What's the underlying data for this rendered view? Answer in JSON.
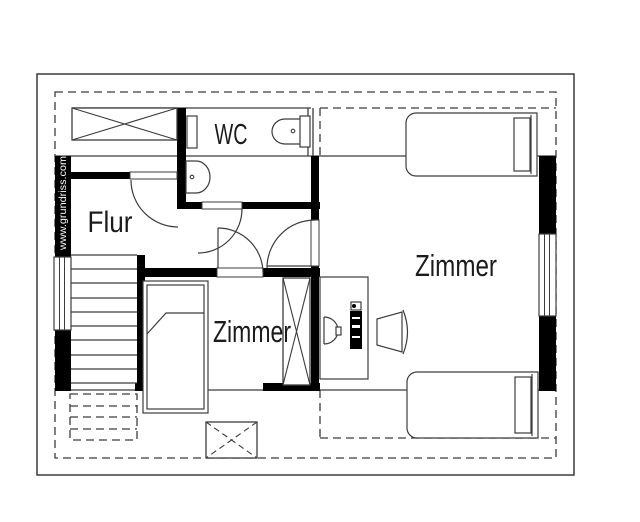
{
  "plan": {
    "meta": {
      "canvas_w": 640,
      "canvas_h": 522,
      "bg": "#ffffff",
      "line_color": "#3c3c3c",
      "wall_color": "#000000",
      "text_color": "#1c1c1c",
      "dash_pattern": "8,5",
      "cross_dash_pattern": "6,4"
    },
    "watermark": {
      "text": "www.grundriss.com",
      "color": "#ffffff",
      "x": 66,
      "y": 203,
      "font_size": 10.5,
      "text_length": 94,
      "rotation": -90
    },
    "room_labels": [
      {
        "name": "room-label-wc",
        "text": "WC",
        "x": 231,
        "y": 144,
        "font_size": 29,
        "text_length": 33
      },
      {
        "name": "room-label-flur",
        "text": "Flur",
        "x": 110,
        "y": 232,
        "font_size": 30,
        "text_length": 45
      },
      {
        "name": "room-label-zimmer-small",
        "text": "Zimmer",
        "x": 252,
        "y": 342,
        "font_size": 31,
        "text_length": 78
      },
      {
        "name": "room-label-zimmer-large",
        "text": "Zimmer",
        "x": 456,
        "y": 276,
        "font_size": 31,
        "text_length": 82
      }
    ],
    "roof_outline": {
      "name": "roof-outline",
      "x": 37,
      "y": 74,
      "w": 537,
      "h": 401
    },
    "dashed_rects": [
      {
        "name": "roof-edge-dashed",
        "x": 55,
        "y": 92,
        "w": 501,
        "h": 366
      },
      {
        "name": "stairs-under-roof-dashed",
        "x": 70,
        "y": 394,
        "w": 67,
        "h": 46
      }
    ],
    "dashed_lines": [
      {
        "name": "knee-dashed-top-h",
        "x1": 320,
        "y1": 108,
        "x2": 556,
        "y2": 108
      },
      {
        "name": "knee-dashed-top-v",
        "x1": 320,
        "y1": 108,
        "x2": 320,
        "y2": 156
      },
      {
        "name": "knee-dashed-bottom-h",
        "x1": 320,
        "y1": 438,
        "x2": 556,
        "y2": 438
      },
      {
        "name": "knee-dashed-bottom-v",
        "x1": 320,
        "y1": 390,
        "x2": 320,
        "y2": 438
      },
      {
        "name": "stairs-dashed-step-1",
        "x1": 70,
        "y1": 406,
        "x2": 137,
        "y2": 406
      },
      {
        "name": "stairs-dashed-step-2",
        "x1": 70,
        "y1": 417,
        "x2": 137,
        "y2": 417
      },
      {
        "name": "stairs-dashed-step-3",
        "x1": 70,
        "y1": 429,
        "x2": 137,
        "y2": 429
      }
    ],
    "lines": [
      {
        "name": "knee-line-top",
        "x1": 55,
        "y1": 156,
        "x2": 556,
        "y2": 156
      },
      {
        "name": "upper-row-top-line",
        "x1": 72,
        "y1": 108,
        "x2": 311,
        "y2": 108
      },
      {
        "name": "knee-line-bottom",
        "x1": 55,
        "y1": 390,
        "x2": 556,
        "y2": 390
      },
      {
        "name": "wc-upper-right-line-1",
        "x1": 308,
        "y1": 108,
        "x2": 308,
        "y2": 156
      },
      {
        "name": "wc-upper-right-line-2",
        "x1": 313,
        "y1": 108,
        "x2": 313,
        "y2": 156
      }
    ],
    "walls": [
      {
        "name": "wall-left-upper",
        "x": 55,
        "y": 156,
        "w": 16,
        "h": 101
      },
      {
        "name": "wall-left-lower",
        "x": 55,
        "y": 330,
        "w": 16,
        "h": 61
      },
      {
        "name": "wall-flur-top",
        "x": 66,
        "y": 172,
        "w": 64,
        "h": 7
      },
      {
        "name": "wall-wc-left",
        "x": 177,
        "y": 108,
        "w": 9,
        "h": 101
      },
      {
        "name": "wall-wc-bottom-left",
        "x": 177,
        "y": 202,
        "w": 25,
        "h": 7
      },
      {
        "name": "wall-wc-bottom-right",
        "x": 242,
        "y": 202,
        "w": 78,
        "h": 7
      },
      {
        "name": "wall-zimmer-large-left-upper",
        "x": 311,
        "y": 156,
        "w": 8,
        "h": 64
      },
      {
        "name": "wall-zimmer-large-left-lower",
        "x": 311,
        "y": 266,
        "w": 8,
        "h": 125
      },
      {
        "name": "wall-zimmer-small-top-left",
        "x": 137,
        "y": 268,
        "w": 80,
        "h": 9
      },
      {
        "name": "wall-zimmer-small-top-right",
        "x": 263,
        "y": 268,
        "w": 57,
        "h": 9
      },
      {
        "name": "wall-stairs-right",
        "x": 137,
        "y": 255,
        "w": 8,
        "h": 136
      },
      {
        "name": "wall-bottom-seg-1",
        "x": 55,
        "y": 383,
        "w": 16,
        "h": 8
      },
      {
        "name": "wall-bottom-seg-2",
        "x": 135,
        "y": 383,
        "w": 12,
        "h": 8
      },
      {
        "name": "wall-bottom-seg-3",
        "x": 263,
        "y": 383,
        "w": 57,
        "h": 8
      },
      {
        "name": "wall-right-upper",
        "x": 539,
        "y": 156,
        "w": 17,
        "h": 79
      },
      {
        "name": "wall-right-lower",
        "x": 539,
        "y": 315,
        "w": 17,
        "h": 76
      }
    ],
    "windows": [
      {
        "name": "window-left",
        "x": 54,
        "y": 257,
        "w": 17,
        "h": 73,
        "inner": [
          59.5,
          64.5
        ],
        "orient": "v"
      },
      {
        "name": "window-right",
        "x": 539,
        "y": 234,
        "w": 17,
        "h": 82,
        "inner": [
          544.5,
          549.5
        ],
        "orient": "v"
      }
    ],
    "thresholds": [
      {
        "name": "threshold-flur-door",
        "x": 130,
        "y": 172,
        "w": 47,
        "h": 7
      },
      {
        "name": "threshold-wc-door",
        "x": 202,
        "y": 202,
        "w": 40,
        "h": 7
      },
      {
        "name": "threshold-zimmer-small-door",
        "x": 217,
        "y": 268,
        "w": 46,
        "h": 9
      },
      {
        "name": "threshold-zimmer-large-door",
        "x": 311,
        "y": 220,
        "w": 8,
        "h": 46
      }
    ],
    "stairs": {
      "name": "staircase",
      "x1": 71,
      "x2": 137,
      "step_ys": [
        255,
        269,
        283,
        298,
        312,
        326,
        340,
        355,
        369,
        383
      ]
    },
    "x_units": [
      {
        "name": "wardrobe-hall",
        "x": 72,
        "y": 108,
        "w": 105,
        "h": 32,
        "cross": "solid"
      },
      {
        "name": "wardrobe-zimmer-small",
        "x": 283,
        "y": 278,
        "w": 27,
        "h": 107,
        "cross": "solid"
      },
      {
        "name": "roof-hatch",
        "x": 206,
        "y": 422,
        "w": 51,
        "h": 36,
        "cross": "dashed"
      }
    ],
    "furniture": [
      {
        "type": "path",
        "name": "bed-large-top",
        "d": "M537,113 L416,113 A10,10 0 0 0 406,123 L406,166 A10,10 0 0 0 416,176 L537,176 Z",
        "fill": "#ffffff"
      },
      {
        "type": "line",
        "name": "bed-large-top-headboard",
        "x1": 531,
        "y1": 115,
        "x2": 531,
        "y2": 174
      },
      {
        "type": "rect",
        "name": "bed-large-top-pillow",
        "x": 514,
        "y": 118,
        "w": 16,
        "h": 53,
        "fill": "#ffffff"
      },
      {
        "type": "path",
        "name": "bed-large-bottom",
        "d": "M538,372 L417,372 A10,10 0 0 0 407,382 L407,428 A10,10 0 0 0 417,438 L538,438 Z",
        "fill": "#ffffff"
      },
      {
        "type": "line",
        "name": "bed-large-bottom-headboard",
        "x1": 532,
        "y1": 374,
        "x2": 532,
        "y2": 436
      },
      {
        "type": "rect",
        "name": "bed-large-bottom-pillow",
        "x": 515,
        "y": 377,
        "w": 16,
        "h": 56,
        "fill": "#ffffff"
      },
      {
        "type": "rect",
        "name": "bed-small",
        "x": 143,
        "y": 281,
        "w": 65,
        "h": 132,
        "fill": "#ffffff"
      },
      {
        "type": "rect",
        "name": "bed-small-inner",
        "x": 147,
        "y": 285,
        "w": 57,
        "h": 124,
        "fill": "none"
      },
      {
        "type": "path",
        "name": "bed-small-blanket-fold",
        "d": "M147,334 L166,313 L204,313",
        "fill": "none"
      },
      {
        "type": "rect",
        "name": "desk",
        "x": 320,
        "y": 277,
        "w": 48,
        "h": 102,
        "fill": "#ffffff"
      },
      {
        "type": "line",
        "name": "monitor-screen",
        "x1": 324,
        "y1": 317,
        "x2": 324,
        "y2": 344
      },
      {
        "type": "path",
        "name": "monitor-body",
        "d": "M324,317 A14,13.5 0 0 1 324,344",
        "fill": "none"
      },
      {
        "type": "rect",
        "name": "monitor-stand",
        "x": 336,
        "y": 327,
        "w": 5,
        "h": 8,
        "fill": "#ffffff"
      },
      {
        "type": "rect",
        "name": "pc-keyboard",
        "x": 350,
        "y": 311,
        "w": 12,
        "h": 38,
        "fill": "#000000",
        "stroke": "none"
      },
      {
        "type": "rect",
        "name": "keyboard-notch-1",
        "x": 352,
        "y": 317,
        "w": 8,
        "h": 2,
        "fill": "#ffffff",
        "stroke": "none"
      },
      {
        "type": "rect",
        "name": "keyboard-notch-2",
        "x": 352,
        "y": 325,
        "w": 8,
        "h": 3,
        "fill": "#ffffff",
        "stroke": "none"
      },
      {
        "type": "rect",
        "name": "keyboard-notch-3",
        "x": 352,
        "y": 336,
        "w": 8,
        "h": 2,
        "fill": "#ffffff",
        "stroke": "none"
      },
      {
        "type": "rect",
        "name": "mouse",
        "x": 351,
        "y": 302,
        "w": 10,
        "h": 8,
        "fill": "#ffffff"
      },
      {
        "type": "circle",
        "name": "mouse-dot",
        "cx": 354,
        "cy": 306,
        "r": 2,
        "fill": "#000000",
        "stroke": "none"
      },
      {
        "type": "path",
        "name": "chair-seat",
        "d": "M377,319 L402,312 L402,352 L377,345 Z",
        "fill": "#ffffff"
      },
      {
        "type": "path",
        "name": "chair-back",
        "d": "M403,310 Q412,332 403,354",
        "fill": "none"
      },
      {
        "type": "path",
        "name": "toilet-bowl",
        "d": "M302,119 L285,119 A13,12.5 0 0 0 285,144 L302,144 Z",
        "fill": "#ffffff"
      },
      {
        "type": "rect",
        "name": "toilet-cistern",
        "x": 300,
        "y": 116,
        "w": 10,
        "h": 31,
        "fill": "#ffffff"
      },
      {
        "type": "circle",
        "name": "toilet-flush-dot",
        "cx": 293,
        "cy": 131,
        "r": 1.8,
        "fill": "none"
      },
      {
        "type": "path",
        "name": "sink",
        "d": "M186,161 L196,161 A14,16 0 0 1 196,193 L186,193 Z",
        "fill": "#ffffff"
      },
      {
        "type": "circle",
        "name": "sink-drain-dot",
        "cx": 192,
        "cy": 177,
        "r": 1.8,
        "fill": "none"
      },
      {
        "type": "rect",
        "name": "wc-upper-door-leaf",
        "x": 187,
        "y": 116,
        "w": 10,
        "h": 32,
        "fill": "#ffffff"
      }
    ],
    "doors": [
      {
        "name": "door-flur",
        "arc": "M131,180 A47,47 0 0 0 178,227"
      },
      {
        "name": "door-wc",
        "arc": "M242,209 A44,44 0 0 1 198,253"
      },
      {
        "name": "door-zimmer-small",
        "arc": "M218,228 A45,45 0 0 1 263,273",
        "leaf": {
          "x1": 218,
          "y1": 228,
          "x2": 218,
          "y2": 268
        }
      },
      {
        "name": "door-zimmer-large",
        "arc": "M315,220 A48,48 0 0 0 267,268",
        "leaf": {
          "x1": 267,
          "y1": 266,
          "x2": 311,
          "y2": 266
        }
      }
    ]
  }
}
